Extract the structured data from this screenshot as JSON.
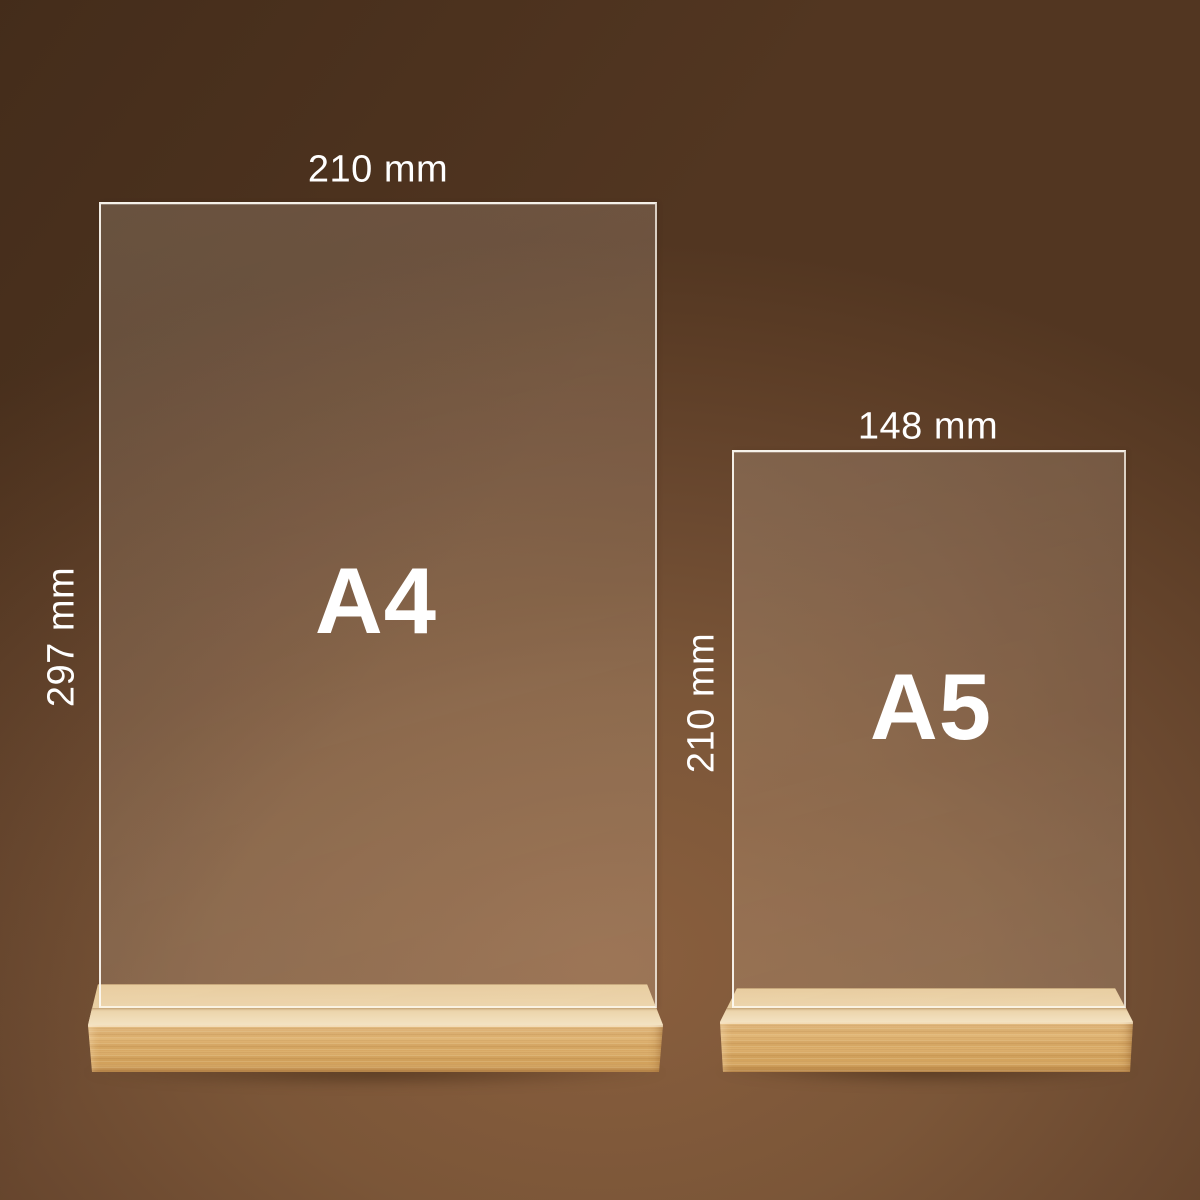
{
  "scene": {
    "type": "product-size-diagram",
    "colors": {
      "background_center": "#8a5f3e",
      "background_edge": "#523621",
      "wood_top": "#e9d0a4",
      "wood_front": "#d8a963",
      "acrylic_edge": "#fdfaf3",
      "label_text": "#ffffff"
    }
  },
  "stands": [
    {
      "id": "a4",
      "format_label": "A4",
      "width_label": "210 mm",
      "height_label": "297 mm"
    },
    {
      "id": "a5",
      "format_label": "A5",
      "width_label": "148 mm",
      "height_label": "210 mm"
    }
  ]
}
